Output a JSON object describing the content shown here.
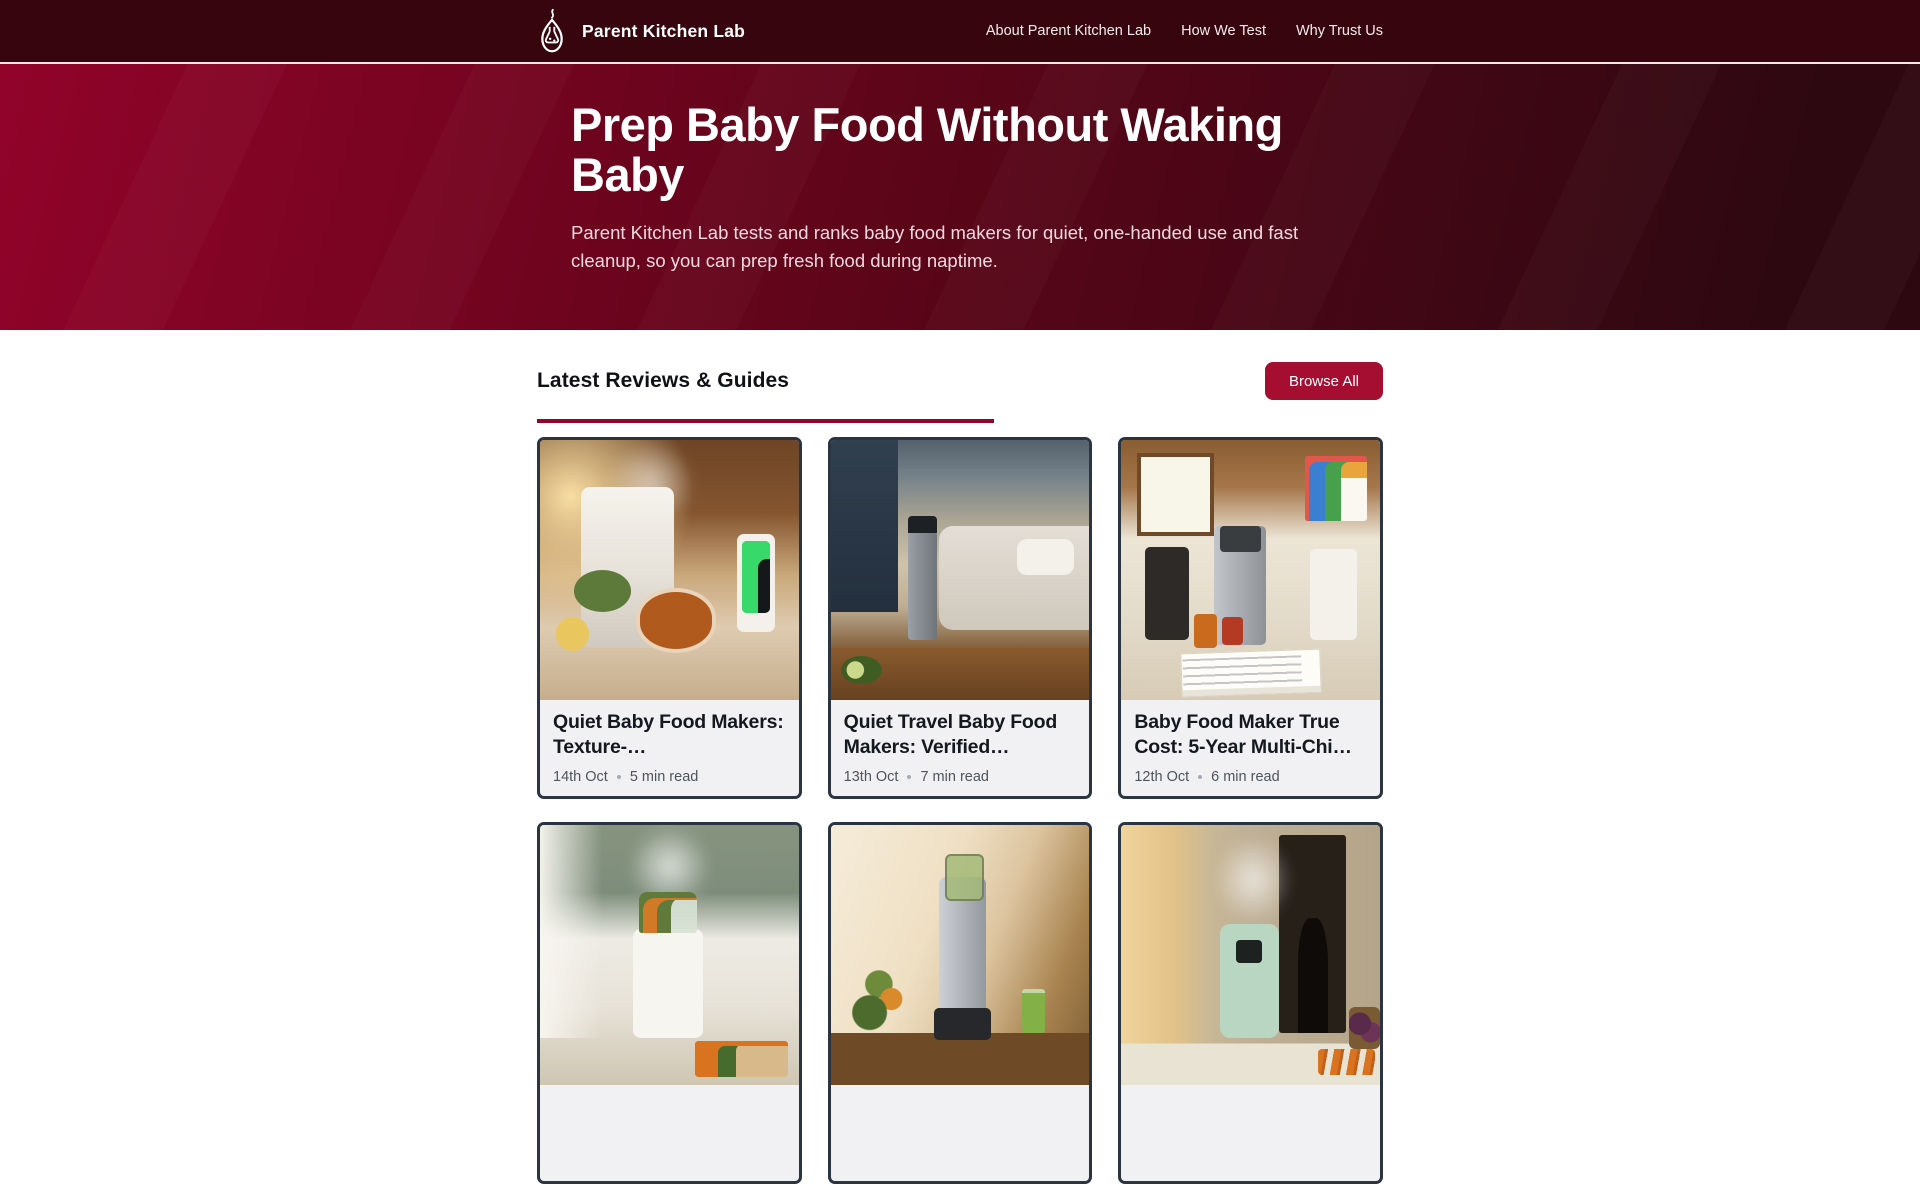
{
  "colors": {
    "accent": "#a50d31",
    "header_bg": "#36050d",
    "header_line": "#f2e8e4",
    "hero_from": "#92032a",
    "hero_mid": "#5d0519",
    "hero_to": "#2e0811",
    "bar": "#90052a",
    "card_border": "#2b3441",
    "card_bg": "#f1f1f3",
    "title_ink": "#14181f",
    "meta_ink": "#4d545c"
  },
  "header": {
    "brand": "Parent Kitchen Lab",
    "logo_icon": "flask-with-steam",
    "nav": [
      {
        "label": "About Parent Kitchen Lab"
      },
      {
        "label": "How We Test"
      },
      {
        "label": "Why Trust Us"
      }
    ]
  },
  "hero": {
    "title": "Prep Baby Food Without Waking Baby",
    "subtitle": "Parent Kitchen Lab tests and ranks baby food makers for quiet, one-handed use and fast cleanup, so you can prep fresh food during naptime."
  },
  "section": {
    "title": "Latest Reviews & Guides",
    "browse_all": "Browse All"
  },
  "articles": [
    {
      "title": "Quiet Baby Food Makers: Texture-…",
      "date": "14th Oct",
      "read": "5 min read",
      "image": "warm sunlit kitchen, white baby food maker, bowl of orange puree, baby monitor with green lights"
    },
    {
      "title": "Quiet Travel Baby Food Makers: Verified…",
      "date": "13th Oct",
      "read": "7 min read",
      "image": "camper bedroom with sleeping child, stainless travel blender on wooden table"
    },
    {
      "title": "Baby Food Maker True Cost: 5-Year Multi-Chi…",
      "date": "12th Oct",
      "read": "6 min read",
      "image": "bright kitchen, lineup of baby food makers, cost sheets and puree jars, kids drawing on wall"
    },
    {
      "image": "sage green kitchen, white steamer with vegetables and steam, chopping board with carrots"
    },
    {
      "image": "slow juicer with green juice on wood counter in warm light"
    },
    {
      "image": "mint green baby food maker steaming, dark doorway with adult silhouette, carrots and basket"
    }
  ]
}
